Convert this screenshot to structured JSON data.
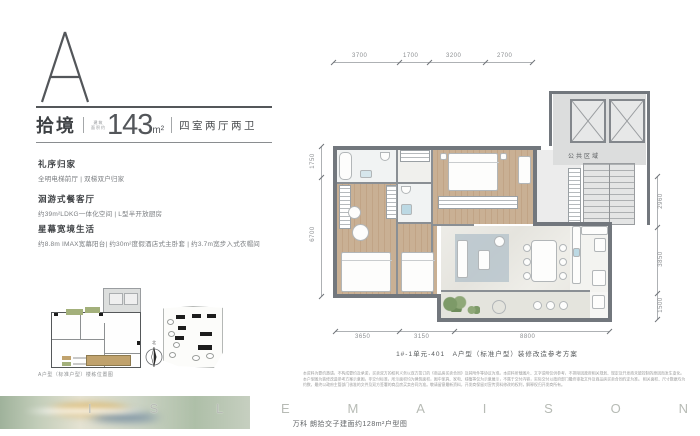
{
  "header": {
    "plan_letter": "A",
    "title": "拾境",
    "area_prefix_line1": "建筑",
    "area_prefix_line2": "面积约",
    "area_value": "143",
    "area_unit": "m²",
    "layout": "四室两厅两卫"
  },
  "features": [
    {
      "heading": "礼序归家",
      "body": "全明电梯前厅 | 双梯双户归家"
    },
    {
      "heading": "洄游式餐客厅",
      "body": "约39m²LDKG一体化空间 | L型半开放厨房"
    },
    {
      "heading": "星幕宽境生活",
      "body": "约8.8m IMAX宽幕阳台| 约30m²度假酒店式主卧套 | 约3.7m宽步入式衣帽间"
    }
  ],
  "keyplan": {
    "caption": "A户型（标准户型）楼栋位置图",
    "compass_label": "北"
  },
  "floorplan": {
    "public_area_label": "公共区域",
    "caption": "1#-1单元-401　A户型（标准户型）装修改造参考方案",
    "dims_top": [
      "3700",
      "1700",
      "3200",
      "2700"
    ],
    "dims_left": [
      "1750",
      "6700"
    ],
    "dims_right": [
      "2960",
      "3850",
      "1500"
    ],
    "dims_bottom": [
      "3650",
      "3150",
      "8800"
    ]
  },
  "footer": {
    "watermark_letters": [
      "I",
      "S",
      "L",
      "E",
      "M",
      "A",
      "I",
      "S",
      "O",
      "N"
    ],
    "caption": "万科 朗拾交子建面约128m²户型图",
    "disclaimer_lines": [
      "本资料为要约邀请，不构成要约及承诺，买卖双方的权利义务以双方签订的《商品房买卖合同》及其附件等协议为准。本资料所载图片、文字说明仅供参考，不排除因政府相关规划、规定及开发商未能控制的原因而发生变化。",
      "本户型图为装修改造参考方案示意图，非交付标准，所示面积均为建筑面积，图中家具、家电、绿植等仅为示意展示，不属于交付内容，实际交付以政府部门最终审批文件及商品房买卖合同约定为准。",
      "相关面积、尺寸数据均为约数，最终以政府主管部门核准的文件及双方签署的商品房买卖合同为准。敬请留意最新资料，开发商保留对宣传资料修改的权利，解释权归开发商所有。"
    ]
  },
  "colors": {
    "accent_dark": "#4a4d50",
    "wall": "#72777d",
    "wood": "#c5ab90",
    "marble": "#e9e8e3",
    "balcony_green": "#7d9a68",
    "keyplan_green": "#a3b07b",
    "keyplan_tan": "#c0a26d"
  }
}
